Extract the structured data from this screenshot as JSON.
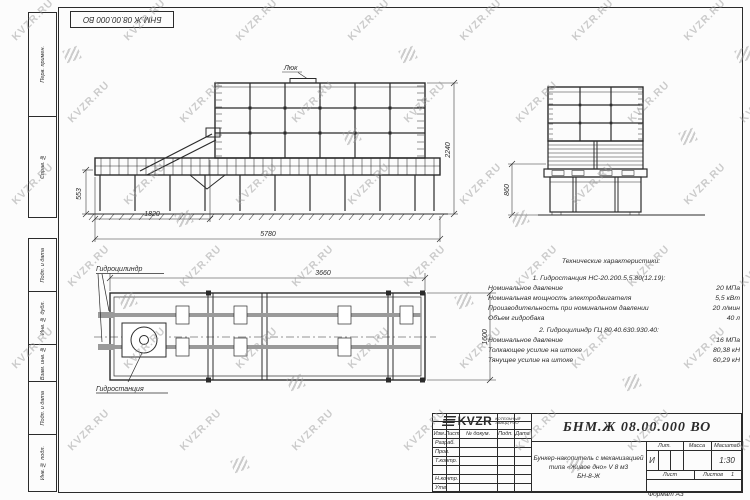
{
  "colors": {
    "line": "#2b2b2b",
    "watermark": "#9b9b9b",
    "sheet": "#fcfcfc"
  },
  "sheet": {
    "stamp": "БНМ.Ж 08.00.000 ВО",
    "format_label": "Формат А3",
    "watermark_text": "KVZR.RU",
    "margin_labels": [
      "Перв. примен.",
      "Справ. №",
      "Подп. и дата",
      "Инв. № дубл.",
      "Взам. инв. №",
      "Подп. и дата",
      "Инв. № подл."
    ]
  },
  "views": {
    "front": {
      "hatch_label": "Люк",
      "dim_height": "2240",
      "dim_base_height": "553",
      "dim_left": "1820",
      "dim_total": "5780"
    },
    "side": {
      "dim_height": "860"
    },
    "plan": {
      "label_cylinder": "Гидроцилиндр",
      "label_station": "Гидростанция",
      "dim_length": "3660",
      "dim_width": "1600"
    }
  },
  "tech_specs": {
    "title": "Технические характеристики:",
    "rows": [
      {
        "label": "1. Гидростанция НС-20.200.5,5.80(12.19):",
        "value": "",
        "group": true
      },
      {
        "label": "Номинальное давление",
        "value": "20 МПа"
      },
      {
        "label": "Номинальная мощность электродвигателя",
        "value": "5,5 кВт"
      },
      {
        "label": "Производительность при номинальном давлении",
        "value": "20 л/мин"
      },
      {
        "label": "Объем гидробака",
        "value": "40 л"
      },
      {
        "label": "2. Гидроцилиндр ГЦ 80.40.630.930.40:",
        "value": "",
        "group": true
      },
      {
        "label": "Номинальное давление",
        "value": "16 МПа"
      },
      {
        "label": "Толкающее усилие на штоке",
        "value": "80,38 кН"
      },
      {
        "label": "Тянущее усилие на штоке",
        "value": "60,29 кН"
      }
    ]
  },
  "title_block": {
    "doc_number": "БНМ.Ж 08.00.000 ВО",
    "description_lines": [
      "Бункер-накопитель с механизацией",
      "типа «Живое дно» V 8 м3",
      "БН-8-Ж"
    ],
    "table_headers": [
      "Изм.",
      "Лист",
      "№ докум.",
      "Подп.",
      "Дата"
    ],
    "approval_rows": [
      "Разраб.",
      "Пров.",
      "Т.контр.",
      "",
      "Н.контр.",
      "Утв."
    ],
    "lit_header": "Лит.",
    "mass_header": "Масса",
    "scale_header": "Масштаб",
    "lit_value": "И",
    "scale_value": "1:30",
    "sheet_label": "Лист",
    "sheets_label": "Листов",
    "sheets_value": "1",
    "logo_text": "KVZR",
    "org_line1": "КОТЕЛЬНЫЙ",
    "org_line2": "ЗАВОД РЭО"
  }
}
